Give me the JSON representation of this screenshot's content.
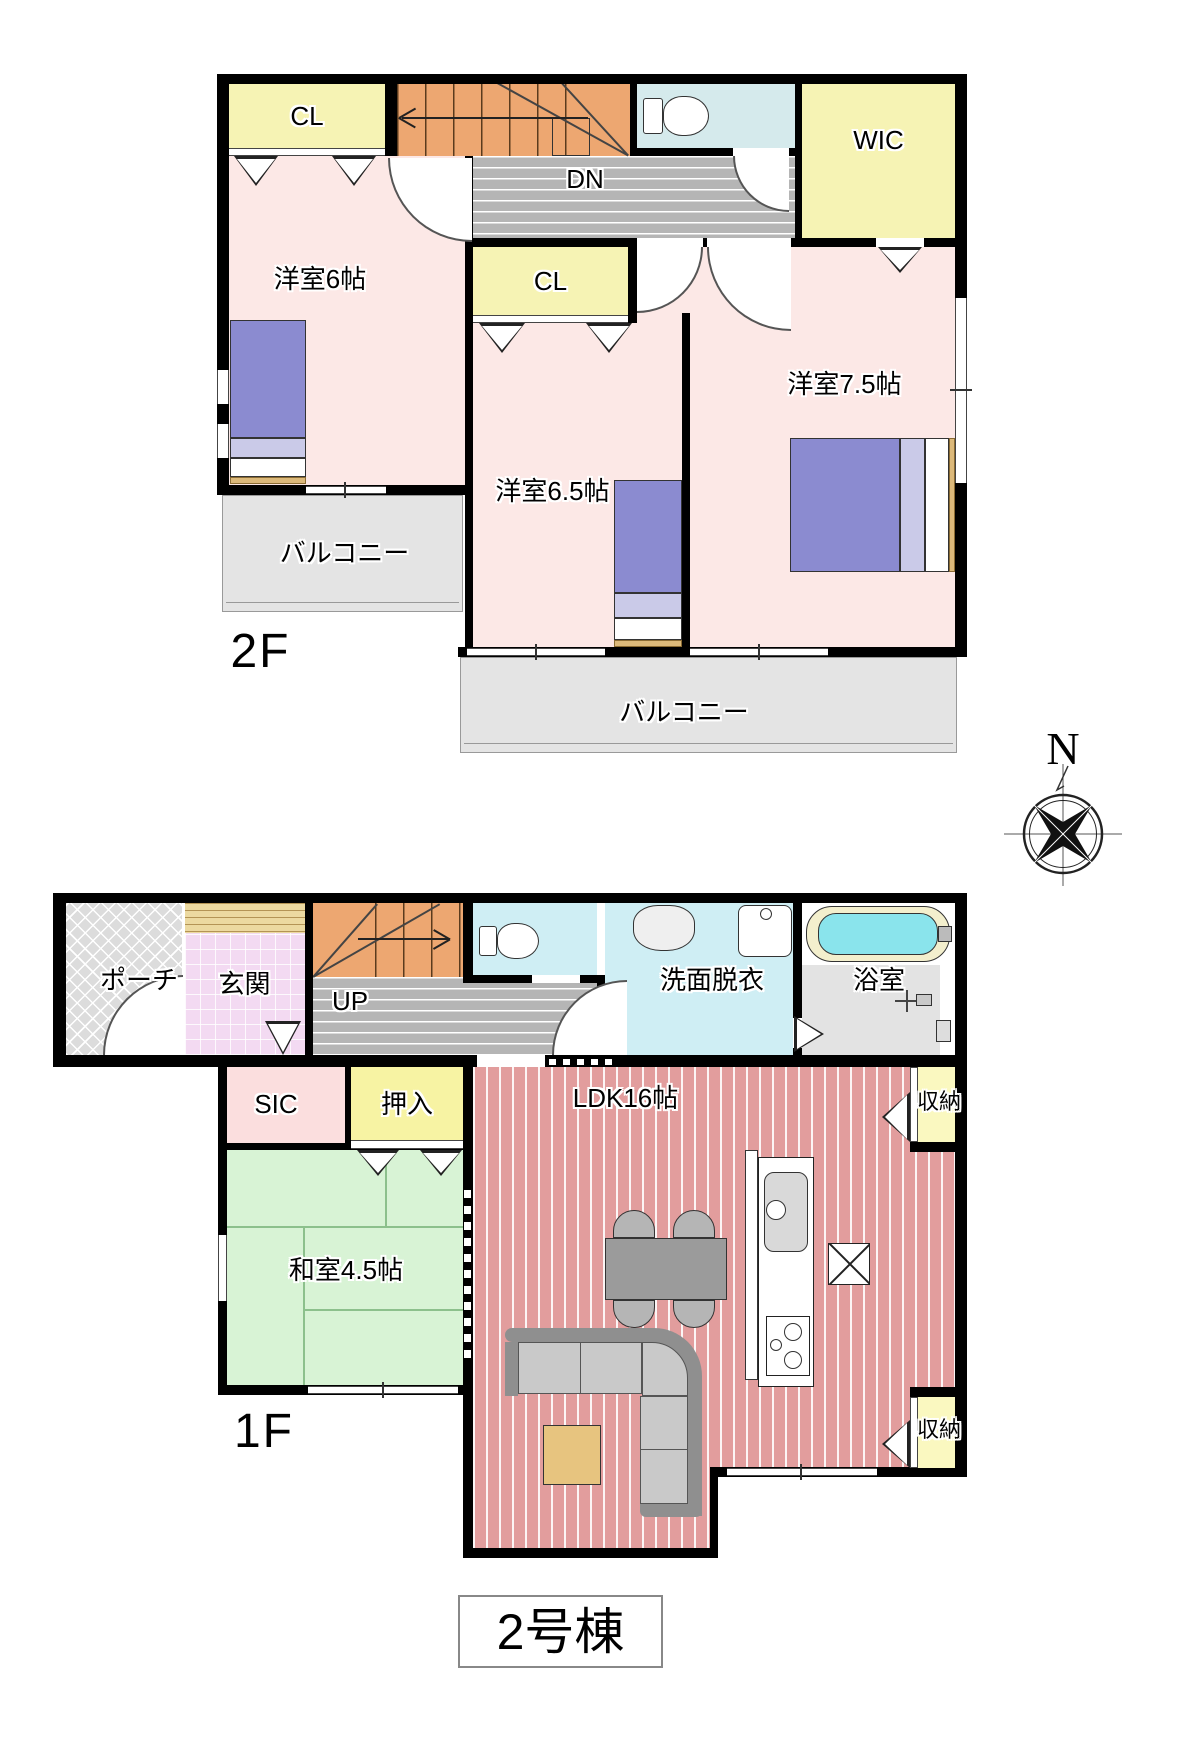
{
  "building_title": "2号棟",
  "compass": {
    "north": "N"
  },
  "f2": {
    "floor": "2F",
    "cl_top": "CL",
    "dn": "DN",
    "wic": "WIC",
    "bedroom6": "洋室6帖",
    "cl_mid": "CL",
    "bedroom65": "洋室6.5帖",
    "bedroom75": "洋室7.5帖",
    "balcony_left": "バルコニー",
    "balcony_main": "バルコニー"
  },
  "f1": {
    "floor": "1F",
    "porch": "ポーチ",
    "entrance": "玄関",
    "up": "UP",
    "washroom": "洗面脱衣",
    "bath": "浴室",
    "sic": "SIC",
    "oshiire": "押入",
    "ldk": "LDK16帖",
    "washitsu": "和室4.5帖",
    "storage_top": "収納",
    "storage_bottom": "収納"
  }
}
